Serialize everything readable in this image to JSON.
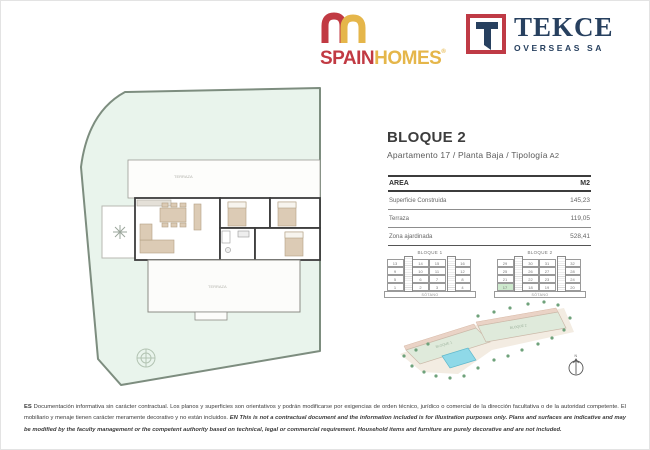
{
  "brand": {
    "spainhomes": {
      "word_primary": "SPAIN",
      "word_secondary": "HOMES",
      "registered": "®"
    },
    "tekce": {
      "monogram": "T",
      "word": "TEKCE",
      "subtitle": "OVERSEAS SA"
    }
  },
  "unit": {
    "title": "BLOQUE 2",
    "apartment": "Apartamento 17",
    "floor": "Planta Baja",
    "typology_label": "Tipología",
    "typology": "A2",
    "separator": "/"
  },
  "area_table": {
    "header": {
      "area": "AREA",
      "unit": "M2"
    },
    "rows": [
      {
        "label": "Superficie Construida",
        "value": "145,23"
      },
      {
        "label": "Terraza",
        "value": "119,05"
      },
      {
        "label": "Zona ajardinada",
        "value": "528,41"
      }
    ]
  },
  "blocks": [
    {
      "name": "BLOQUE 1",
      "basement": "SÓTANO",
      "highlight": null,
      "floors": [
        [
          "13",
          "14",
          "15",
          "16"
        ],
        [
          "9",
          "10",
          "11",
          "12"
        ],
        [
          "5",
          "6",
          "7",
          "8"
        ],
        [
          "1",
          "2",
          "3",
          "4"
        ]
      ]
    },
    {
      "name": "BLOQUE 2",
      "basement": "SÓTANO",
      "highlight": "17",
      "floors": [
        [
          "29",
          "30",
          "31",
          "32"
        ],
        [
          "25",
          "26",
          "27",
          "28"
        ],
        [
          "21",
          "22",
          "23",
          "24"
        ],
        [
          "17",
          "18",
          "19",
          "20"
        ]
      ]
    }
  ],
  "floorplan": {
    "terrace_top": "TERRAZA",
    "terrace_bottom": "TERRAZA"
  },
  "siteplan": {
    "building1": "BLOQUE 1",
    "building2": "BLOQUE 2",
    "north": "N"
  },
  "footer": {
    "es_prefix": "ES",
    "es_text": "Documentación informativa sin carácter contractual. Los planos y superficies son orientativos y podrán modificarse por exigencias de orden técnico, jurídico o comercial de la dirección facultativa o de la autoridad competente. El mobiliario y menaje tienen carácter meramente decorativo y no están incluidos.",
    "en_prefix": "EN",
    "en_text": "This is not a contractual document and the information included is for illustration purposes only. Plans and surfaces are indicative and may be modified by the faculty management or the competent authority based on technical, legal or commercial requirement. Household items and furniture are purely decorative and are not included."
  },
  "colors": {
    "brand_red": "#c13a43",
    "brand_gold": "#e5b64a",
    "tekce_navy": "#27405f",
    "highlight_green": "#cde9cd",
    "plot_green": "#e9f4ec"
  }
}
